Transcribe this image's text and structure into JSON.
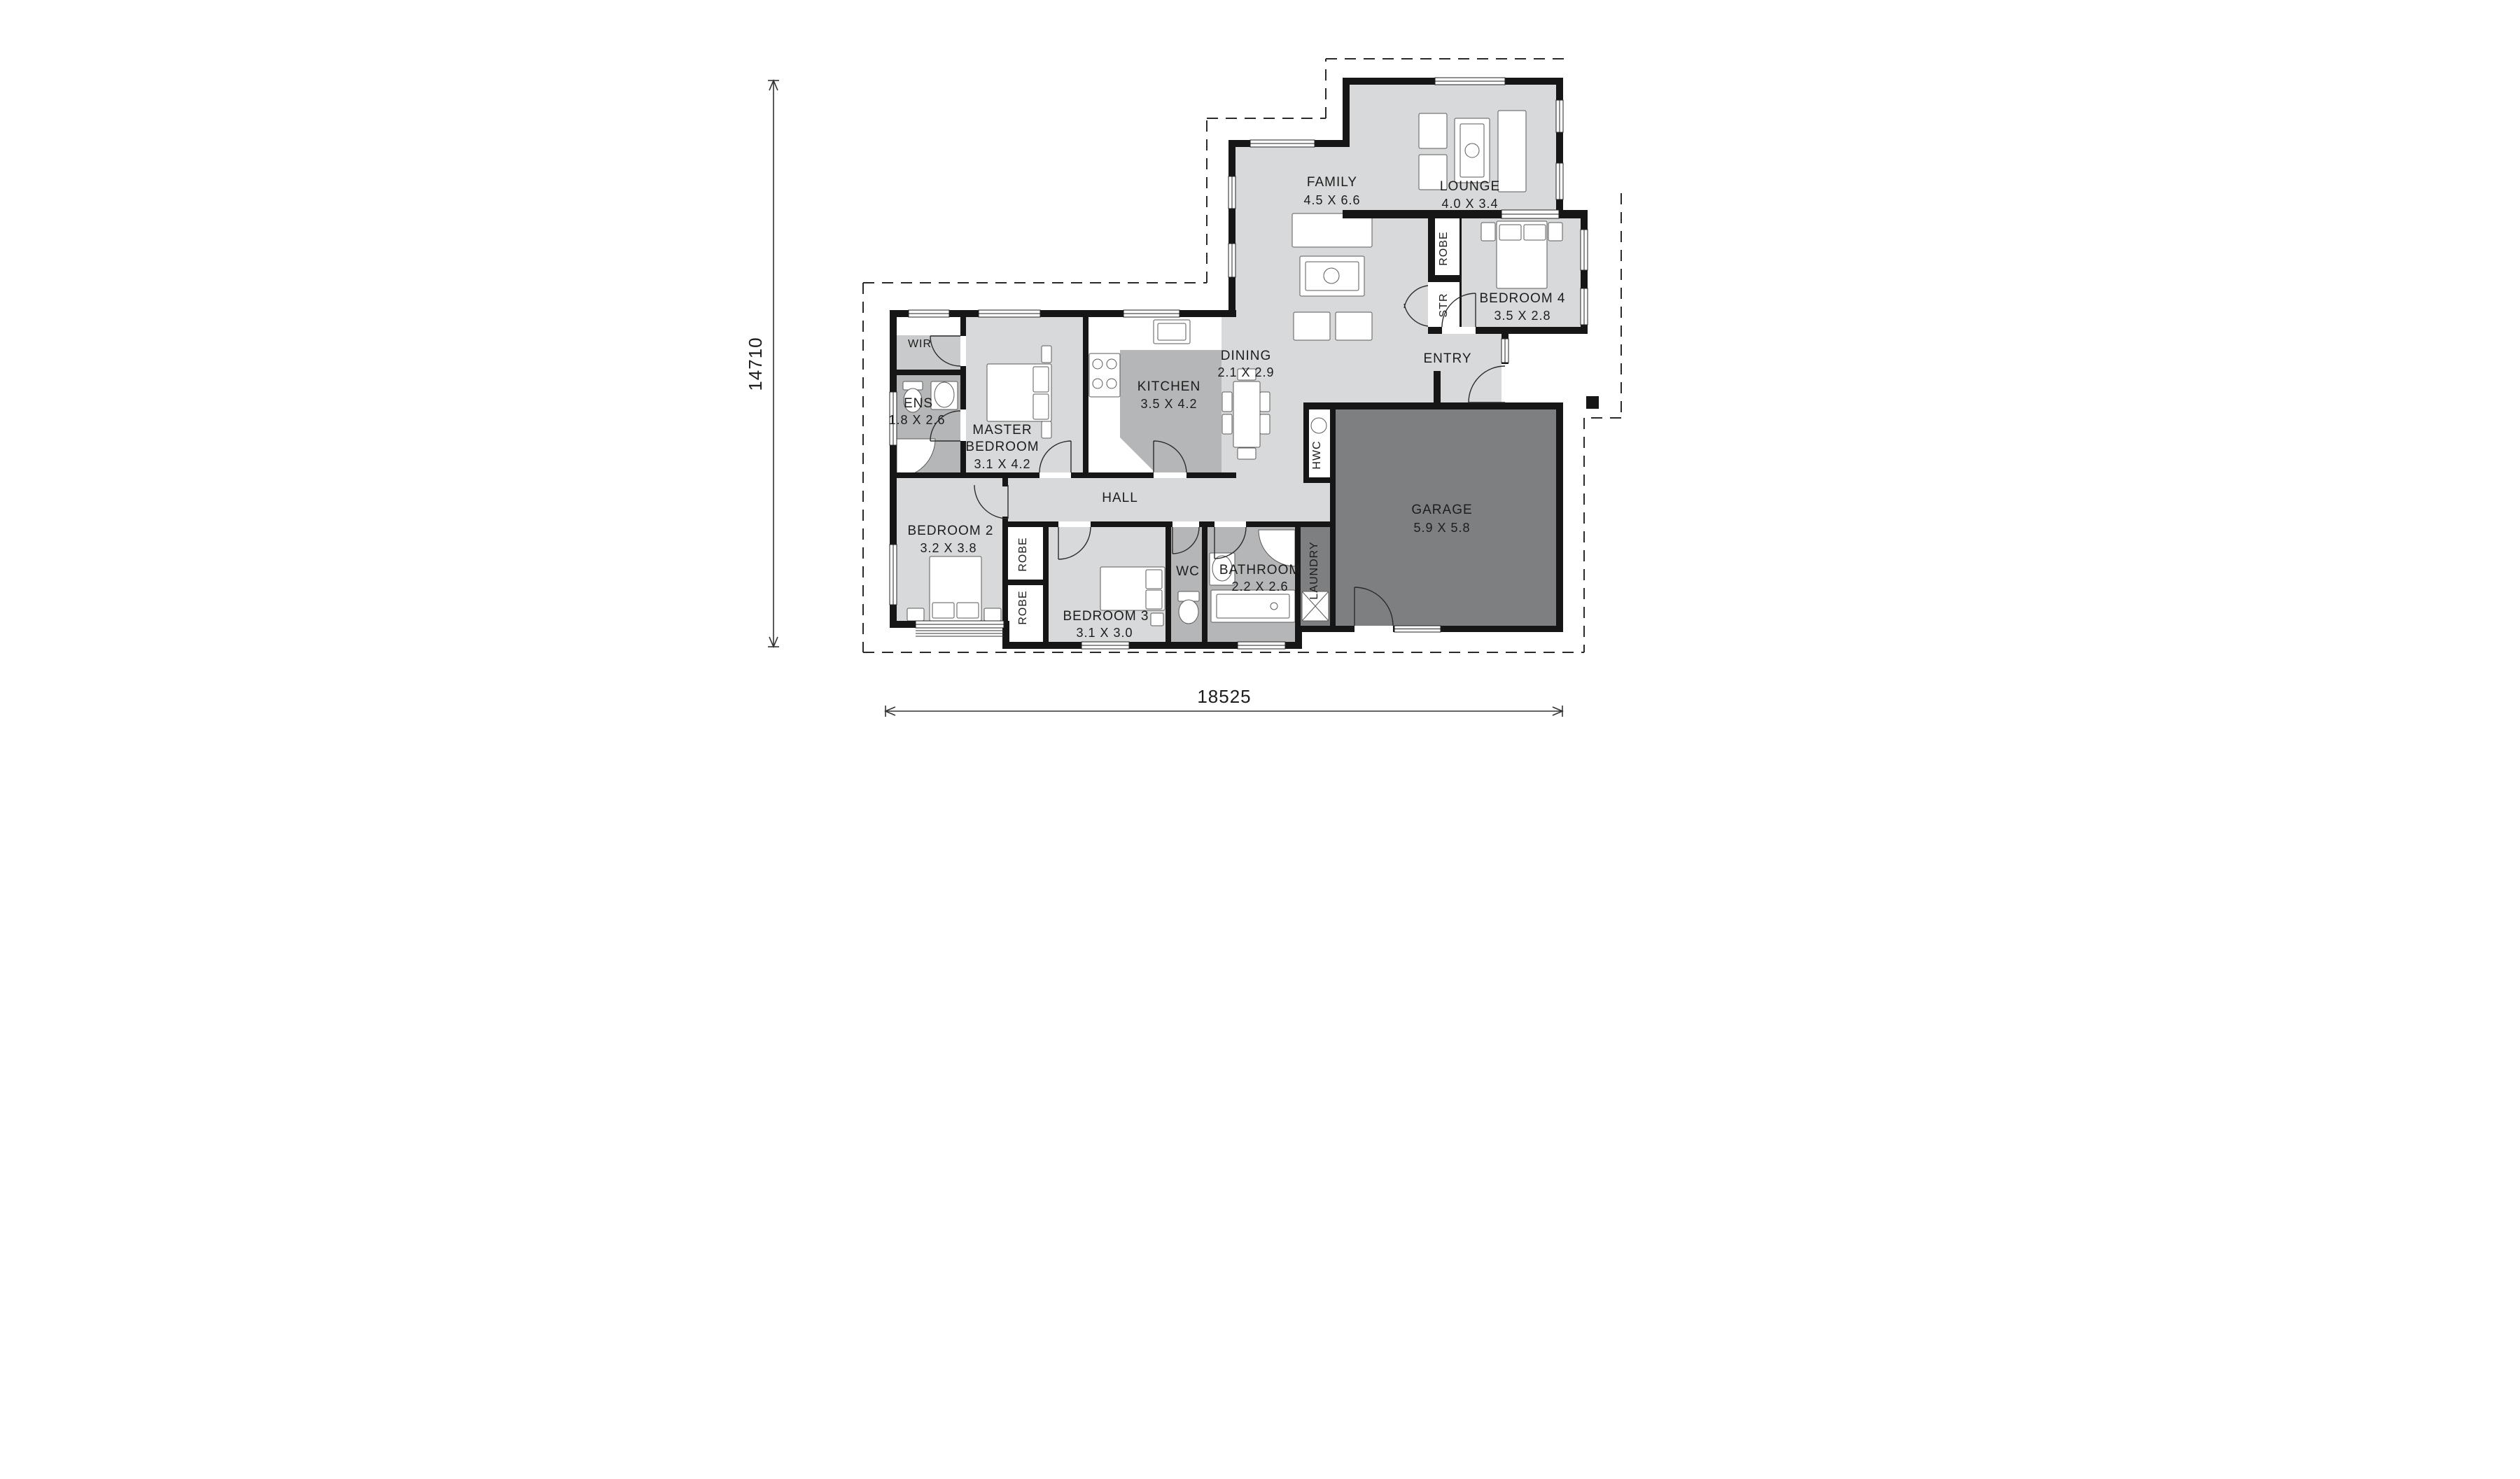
{
  "rooms": {
    "family": {
      "name": "FAMILY",
      "dims": "4.5 X 6.6"
    },
    "lounge": {
      "name": "LOUNGE",
      "dims": "4.0 X 3.4"
    },
    "bedroom4": {
      "name": "BEDROOM 4",
      "dims": "3.5 X 2.8"
    },
    "dining": {
      "name": "DINING",
      "dims": "2.1 X 2.9"
    },
    "kitchen": {
      "name": "KITCHEN",
      "dims": "3.5 X 4.2"
    },
    "master": {
      "line1": "MASTER",
      "line2": "BEDROOM",
      "dims": "3.1 X 4.2"
    },
    "wir": {
      "name": "WIR"
    },
    "ens": {
      "name": "ENS",
      "dims": "1.8 X 2.6"
    },
    "hall": {
      "name": "HALL"
    },
    "bedroom2": {
      "name": "BEDROOM 2",
      "dims": "3.2 X 3.8"
    },
    "bedroom3": {
      "name": "BEDROOM 3",
      "dims": "3.1 X 3.0"
    },
    "wc": {
      "name": "WC"
    },
    "bathroom": {
      "name": "BATHROOM",
      "dims": "2.2 X 2.6"
    },
    "laundry": {
      "name": "LAUNDRY"
    },
    "garage": {
      "name": "GARAGE",
      "dims": "5.9 X 5.8"
    },
    "entry": {
      "name": "ENTRY"
    }
  },
  "closets": {
    "robe": "ROBE",
    "str": "STR",
    "hwc": "HWC"
  },
  "dimensions": {
    "overall_height": "14710",
    "overall_width": "18525"
  },
  "colors": {
    "room_light": "#d8d9da",
    "room_mid": "#b5b6b7",
    "room_wir": "#c9cacb",
    "garage_dark": "#7e7f80",
    "wall": "#161616",
    "furniture_stroke": "#5a5a5a",
    "dash": "#2a2a2a"
  }
}
